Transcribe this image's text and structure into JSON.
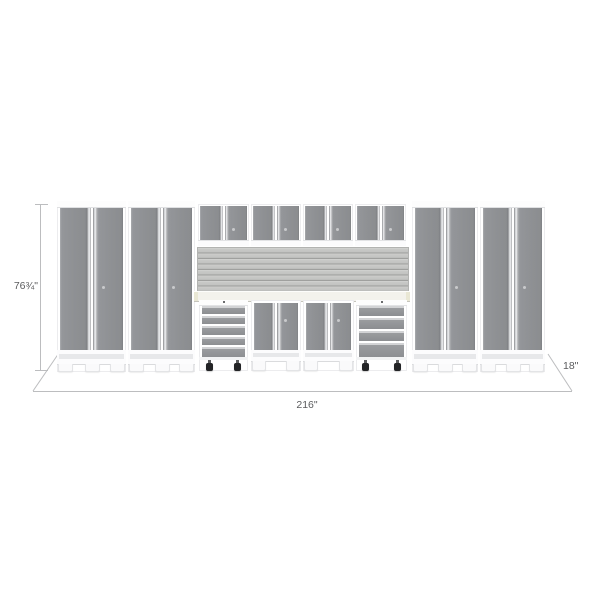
{
  "annotations": {
    "height_label": "76¾\"",
    "width_label": "216\"",
    "depth_label": "18\""
  },
  "colors": {
    "background": "#ffffff",
    "cabinet_frame": "#ffffff",
    "door_gray": "#909295",
    "handle_silver": "#f0f1f3",
    "slatwall_gray": "#c6c7c5",
    "worktop_cream": "#f3f2ec",
    "caster_black": "#232426",
    "dimension_line": "#bcbdbf",
    "dimension_text": "#5a5b5d"
  }
}
